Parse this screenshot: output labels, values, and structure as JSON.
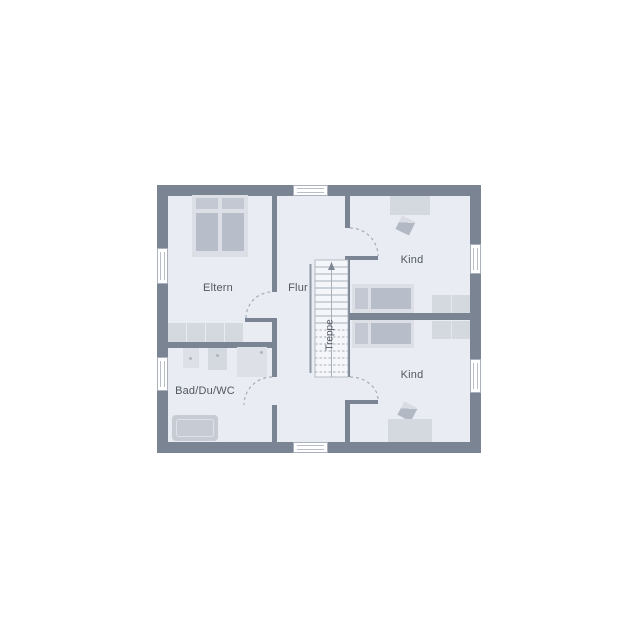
{
  "plan": {
    "type": "floorplan-upper-storey",
    "labels": {
      "eltern": "Eltern",
      "flur": "Flur",
      "kind_top": "Kind",
      "kind_bottom": "Kind",
      "bad": "Bad/Du/WC",
      "treppe": "Treppe"
    },
    "colors": {
      "background": "#ffffff",
      "wall": "#7a8492",
      "floor": "#e9edf3",
      "furniture_light": "#dcdfe6",
      "furniture_mid": "#d4d8df",
      "furniture_dark": "#b8bec9",
      "stair_fill": "#f4f6fa",
      "line": "#a6adb8",
      "label_text": "#51565f"
    },
    "elements": {
      "windows": 6,
      "door_swings": 4,
      "furniture": [
        "double-bed",
        "wardrobe",
        "washbasin",
        "washbasin",
        "shower",
        "bathtub",
        "single-bed",
        "desk",
        "chair",
        "dresser",
        "single-bed",
        "desk",
        "chair",
        "dresser",
        "staircase"
      ]
    }
  }
}
